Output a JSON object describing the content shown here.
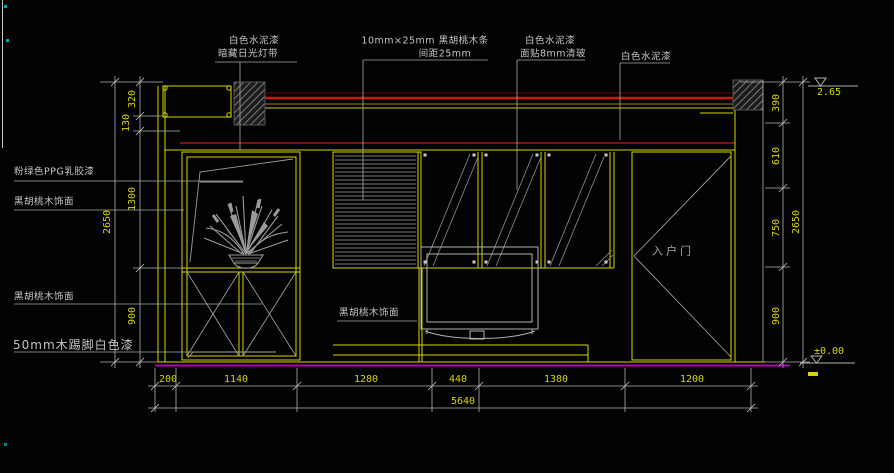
{
  "drawing_title": "living-room TV wall elevation",
  "colors": {
    "line_yellow": "#d6d600",
    "dim_text_yellow": "#d6d600",
    "annotation_gray": "#c4c4c4",
    "ceiling_red": "#d01414",
    "floor_magenta": "#b400b4",
    "background": "#030303"
  },
  "annotations": {
    "ceiling_note": {
      "line1": "白色水泥漆",
      "line2": "暗藏日光灯带"
    },
    "slat_note": {
      "line1": "10mm×25mm 黑胡桃木条",
      "line2": "间距25mm"
    },
    "glass_note": {
      "line1": "白色水泥漆",
      "line2": "面贴8mm清玻"
    },
    "wall_note": {
      "line1": "白色水泥漆"
    },
    "left_notes": [
      "粉绿色PPG乳胶漆",
      "黑胡桃木饰面",
      "黑胡桃木饰面",
      "50mm木踢脚白色漆"
    ],
    "tv_cabinet_note": "黑胡桃木饰面",
    "door_label": "入户门"
  },
  "dimensions": {
    "bottom_segments": [
      "200",
      "1140",
      "1280",
      "440",
      "1380",
      "1200"
    ],
    "bottom_total": "5640",
    "left_segments": [
      "320",
      "130",
      "1300",
      "900"
    ],
    "left_total": "2650",
    "right_segments": [
      "390",
      "610",
      "750",
      "900"
    ],
    "right_total": "2650",
    "level_top": "2.65",
    "level_floor": "±0.00"
  }
}
